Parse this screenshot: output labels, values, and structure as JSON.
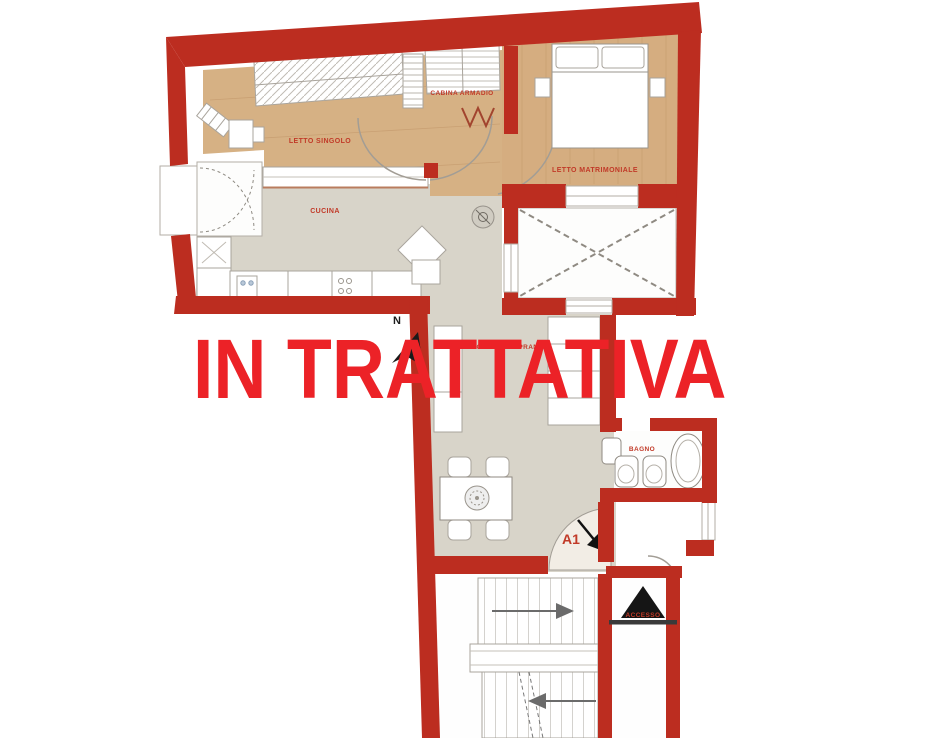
{
  "watermark": {
    "text": "IN TRATTATIVA",
    "color": "#ec2227"
  },
  "rooms": {
    "letto_singolo": "LETTO SINGOLO",
    "cabina_armadio": "CABINA ARMADIO",
    "letto_matrimoniale": "LETTO MATRIMONIALE",
    "cucina": "CUCINA",
    "soggiorno_pranzo": "SOGGIORNO PRANZO",
    "bagno": "BAGNO"
  },
  "annotations": {
    "entrance_label": "A1",
    "access_label": "ACCESSO",
    "compass_north": "N"
  },
  "colors": {
    "wall_red": "#bc2d20",
    "label_red": "#c13a28",
    "watermark_red": "#ec2227",
    "wood_floor": "#d6b184",
    "tile_grey": "#d8d4c9"
  }
}
